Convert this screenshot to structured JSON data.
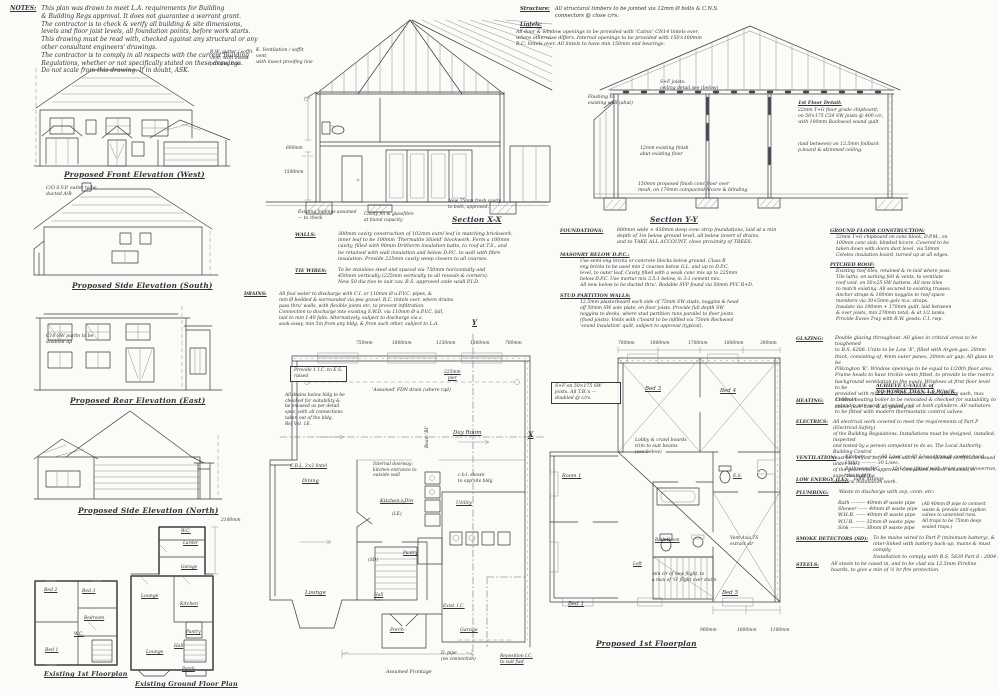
{
  "notes": {
    "heading": "NOTES:",
    "lines": [
      "This plan was drawn to meet L.A. requirements for Building",
      "& Building Regs approval. It does not guarantee a warrant grant.",
      "The contractor is to check & verify all building & site dimensions,",
      "levels and floor joist levels, all foundation points, before work starts.",
      "This drawing must be read with, checked against any structural or any",
      "other consultant engineers' drawings.",
      "The contractor is to comply in all respects with the current Building",
      "Regulations, whether or not specifically stated on these drawings.",
      "Do not scale from this drawing.     If in doubt,  ASK."
    ]
  },
  "elevations": {
    "front_caption": "Proposed Front Elevation (West)",
    "south_caption": "Proposed Side Elevation (South)",
    "rear_caption": "Proposed Rear Elevation (East)",
    "north_caption": "Proposed Side Elevation (North)",
    "svp_note_lines": [
      "C/O S.V.P. outlet to be",
      "ducted A/R"
    ],
    "purlin_note_lines": [
      "C16 SW purlin to be",
      "doubled up"
    ],
    "gutter_note_lines": [
      "R.W. gutter / soffit",
      "vent, with insect",
      "proofing line"
    ]
  },
  "sections": {
    "xx_caption": "Section X-X",
    "yy_caption": "Section Y-Y",
    "vent_note_lines": [
      "K. Ventilation / soffit vent,",
      "with insect proofing line"
    ],
    "structure_heading": "Structure:",
    "structure_lines": [
      "All structural timbers to be jointed via 12mm Ø bolts & C.N.S.",
      "connectors @ close c/rs."
    ],
    "lintels_heading": "Lintels:",
    "lintels_lines": [
      "All door & window openings to be provided with 'Catnic' CN14 lintels over,",
      "where otherwise differs. Internal openings to be provided with 150×100mm",
      "R.C. lintels over. All lintels to have min 150mm end bearings."
    ],
    "dim_600": "600mm",
    "dim_1500": "1500mm",
    "xx_cavity_note_lines": [
      "New 75mm fresh cavity",
      "to both, approved."
    ],
    "xx_footings_note_lines": [
      "Existing footings assumed",
      "— to check"
    ],
    "xx_fill_note_lines": [
      "Cavity fill & glassfibre",
      "at found capacity"
    ],
    "yy_joists_note_lines": [
      "S+F joists:",
      "ceiling detail see (below)"
    ],
    "yy_floor_detail_heading": "1st Floor Detail:",
    "yy_floor_detail_lines": [
      "22mm T+G floor grade chipboard,",
      "on 50×175 C24 SW joists @ 400 c/c,",
      "with 100mm Rockwool sound quilt"
    ],
    "yy_pboard_lines": [
      "(laid between) on 12.5mm foilback",
      "p.board & skimmed ceiling."
    ],
    "yy_flashing_lines": [
      "Flashing to",
      "existing wall (abut)"
    ],
    "yy_finish_note_lines": [
      "12mm existing finish",
      "abut existing floor"
    ],
    "yy_floor_lines": [
      "150mm proposed finish conc floor over",
      "mesh, on 170mm compacted h/core & blinding"
    ]
  },
  "specs": {
    "walls_heading": "WALLS:",
    "walls_lines": [
      "300mm cavity construction of 102mm extnl leaf in matching brickwork,",
      "inner leaf to be 100mm 'Thermalite Shield' blockwork. Form a 100mm",
      "cavity, filled with 90mm Dritherm insulation batts, to roof at T.S., and",
      "be retained with wall insulation and below D.P.C. to wall with fibre",
      "insulation. Provide 225mm cavity weep closers to all courses."
    ],
    "ties_heading": "TIE WIRES:",
    "ties_lines": [
      "To be stainless steel and spaced via 750mm horizontally and",
      "450mm vertically (225mm vertically to all reveals & corners).",
      "New 50 dia ties to suit cav. B.S. approved code w/all P.I.D."
    ],
    "drains_heading": "DRAINS:",
    "drains_lines": [
      "All foul water to discharge with C.I. or 110mm Ø u.P.V.C. pipes, &",
      "min Ø bedded & surrounded via pea gravel. R.C. lintels over, where drains",
      "pass thru' walls, with flexible joints etc, to prevent infiltration.",
      "Connection to discharge into existing S.W.D. via 110mm Ø u.P.V.C. fall,",
      "laid to min 1:40 falls. Alternatively, subject to discharge via a",
      "soak-away, min 5m from any bldg, & from such other, subject to L.A."
    ],
    "foundations_heading": "FOUNDATIONS:",
    "foundations_lines": [
      "600mm wide × 450mm deep conc strip foundations, laid at a min",
      "depth of 1m below ground level, all below invert of drains,",
      "and to TAKE ALL ACCOUNT, close proximity of TREES."
    ],
    "masonry_heading": "MASONRY BELOW D.P.C.:",
    "masonry_lines": [
      "Use semi-eng bricks or concrete blocks below ground. Class B",
      "eng bricks to be used min 2 courses below G.L. and up to D.P.C.",
      "level, to outer leaf. Cavity filled with a weak conc mix up to 225mm",
      "below D.P.C. Use mortar mix 3.5:1 below, in 3:1 cement mix.",
      "All new below to be ducted thru'. Rodable SVP found via 50mm PVC R+D."
    ],
    "stud_heading": "STUD PARTITION WALLS:",
    "stud_lines": [
      "12.5mm plasterboard each side of 75mm SW studs, noggins & head",
      "off 50mm SW sole plate, on floor joists. Provide full depth SW",
      "noggins to decks, where stud partition runs parallel to floor joists",
      "(fixed joists). Voids with c'board to be infilled via 75mm Rockwool",
      "'sound insulation' quilt, subject to approval (typical)."
    ],
    "gfc_heading": "GROUND FLOOR CONSTRUCTION:",
    "gfc_lines": [
      "22mm T+G chipboard on conc block, D.P.M., on",
      "100mm conc slab, blinded h/core. Covered to be",
      "taken down with doors duct level, via 50mm",
      "Celotex insulation board, turned up at all edges."
    ],
    "roof_heading": "PITCHED ROOF:",
    "roof_lines": [
      "Existing roof tiles, retained & re-laid where poss.",
      "Tile laths, on sarking felt & vents, to ventilate",
      "roof void, on 50×25 SW battens. All new tiles",
      "to match existing. All secured to existing trusses.",
      "Anchor straps & 100mm noggins to roof space",
      "members via 30×5mm galv m.s. straps.",
      "Insulate via 100mm + 170mm quilt, laid between",
      "& over joists, min 270mm total, & at 1/2 tanks.",
      "Provide Eaves Tray with R.W. goods: C.I. rwp."
    ]
  },
  "right_specs": {
    "glazing_heading": "GLAZING:",
    "glazing_lines": [
      "Double glazing throughout. All glass in critical areas to be toughened",
      "to B.S. 6206. Units to be Low 'E', filled with Argon gas. 28mm",
      "thick, consisting of, 4mm outer panes, 20mm air gap. All glass to be",
      "Pilkington 'K'. Window openings to be equal to 1/20th floor area.",
      "Frame heads to have trickle vents fitted, to provide to the room's",
      "background ventilation to the equiv. Windows at first floor level to be",
      "provided with min 450×750mm clear free opening sash, max 1100mm",
      "above floor line, & all glazing to"
    ],
    "glazing_uvalue_lines": [
      "ACHIEVE U-VALUE of",
      "NO WORSE THAN 1.6 W/m²K."
    ],
    "heating_heading": "HEATING:",
    "heating_lines": [
      "Central heating boiler to be relocated & checked for suitability, to",
      "extend a min work'g 'sealed' coil at both cylinders. All radiators",
      "to be fitted with modern thermostatic control valves."
    ],
    "electrics_heading": "ELECTRICS:",
    "electrics_lines": [
      "All electrical work covered to meet the requirements of Part P (Electrical Safety)",
      "of the Building Regulations. Installations must be designed, installed, inspected",
      "and tested by a person competent to do so. The Local Authority Building Control",
      "must be notified before work starts, or, completion certificates issued under one",
      "of the government-approved 'Competent Person' schemes, in supervision of the",
      "electrical installation work."
    ],
    "ventilation_heading": "VENTILATION:",
    "ventilation_lines": [
      "Kitchen ———  60 L/sec,  or  30 L/sec through cooker hood.",
      "Utility ———  30 L/sec.",
      "Bathroom/WC —— 15 L/sec (fitted with timer control/overrun, 'the light')"
    ],
    "low_energy_heading": "LOW ENERGY (LE):",
    "low_energy_text": "light fittings",
    "plumbing_heading": "PLUMBING:",
    "plumbing_intro": "Waste to discharge with svp, conn. etc:",
    "plumbing_lines": [
      "Bath ———  40mm Ø waste pipe",
      "Shower ——  40mm Ø waste pipe",
      "W.H.B. ——  40mm Ø waste pipe",
      "W.U.B. ——  32mm Ø waste pipe",
      "Sink ———  38mm Ø waste pipe"
    ],
    "plumbing_note_lines": [
      "(All 40mm Ø pipe to connect",
      "waste & provide anti-syphon",
      "valves to unvented runs.",
      "All traps to be 75mm deep",
      "sealed traps.)"
    ],
    "smoke_heading": "SMOKE DETECTORS (SD):",
    "smoke_lines": [
      "To be mains wired to Part P (minimum battery), &",
      "inter-linked with battery back-up, mains & must comply.",
      "Installation to comply with B.S. 5839  Part 6 : 2004."
    ],
    "steels_heading": "STEELS:",
    "steels_lines": [
      "All steels to be cased in, and to be clad via 12.5mm Fireline",
      "boards, to give a min of ½ hr fire protection."
    ]
  },
  "gf_plan": {
    "dims_top": [
      "750mm",
      "1800mm",
      "1150mm",
      "1800mm",
      "700mm"
    ],
    "pier_lines": [
      "225mm",
      "pier"
    ],
    "fdn_note": "'Assumed' FDN drain (where rqd)",
    "ic_note_lines": [
      "Provide 1 I.C. to E.S.",
      "raised"
    ],
    "drain_check_lines": [
      "All drains below bldg to be",
      "checked for suitability &",
      "be encased as per detail",
      "spec, with all connections",
      "taken out of the bldg.",
      "Ref Vol. 1E."
    ],
    "cbl_note": "C.B.L. 3×2 lintel",
    "internal_note_lines": [
      "Internal doorway:",
      "kitchen entrance to",
      "outside wall"
    ],
    "units_note_lines": [
      "c.b.l. shown",
      "to opp'site bldg"
    ],
    "beam_label": "Beam 'B1'",
    "rooms": {
      "dining": "Dining",
      "day_room": "Day Room",
      "kitchen": "Kitchen / Din",
      "lounge": "Lounge",
      "utility": "Utility",
      "pantry": "Pantry",
      "hall": "Hall",
      "porch": "Porch",
      "garage": "Garage"
    },
    "tokens": {
      "le": "(LE)",
      "sd": "(SD)"
    },
    "existing_ic": "Exist. I.C.",
    "reposition_lines": [
      "Reposition I.C.",
      "to suit fwd"
    ],
    "dpipe_lines": [
      "D. pipe",
      "(no connection)"
    ],
    "frontage": "Assumed Frontage"
  },
  "ff_plan": {
    "caption": "Proposed 1st Floorplan",
    "dims_top": [
      "700mm",
      "1800mm",
      "1700mm",
      "1800mm",
      "300mm"
    ],
    "dims_bottom": [
      "900mm",
      "1800mm",
      "1100mm"
    ],
    "joists_note_lines": [
      "S+F on 50×175 SW",
      "joists. All T.B.'s —",
      "doubled @ c/rs."
    ],
    "lobby_note_lines": [
      "Lobby & crawl boards",
      "trim to suit beams",
      "(see below)"
    ],
    "vent_note_lines": [
      "Vent-Axia TS",
      "extract air"
    ],
    "head_note_lines": [
      "min clr of new flight, to",
      "a max of 'G' flight over stairs"
    ],
    "rooms": {
      "bed3": "Bed 3",
      "bed4": "Bed 4",
      "bed5": "Bed 5",
      "bed1": "Bed 1",
      "room1": "Room 1",
      "bath": "Bath Room",
      "es": "E.S.",
      "loft": "Loft"
    }
  },
  "existing_plans": {
    "ff_caption": "Existing 1st Floorplan",
    "gf_caption": "Existing Ground Floor Plan",
    "ff_rooms": {
      "bed2": "Bed 2",
      "bed3": "Bed 3",
      "bedroom": "Bedroom",
      "wc": "W.C.",
      "bed1": "Bed 1"
    },
    "gf_rooms": {
      "wc": "W.C.",
      "larder": "Larder",
      "garage": "Garage",
      "lounge_rear": "Lounge",
      "kitchen": "Kitchen",
      "lounge_front": "Lounge",
      "pantry": "Pantry",
      "hall": "Hall",
      "porch": "Porch"
    },
    "dim": "2100mm"
  },
  "markers": {
    "x": "X",
    "y": "Y"
  }
}
